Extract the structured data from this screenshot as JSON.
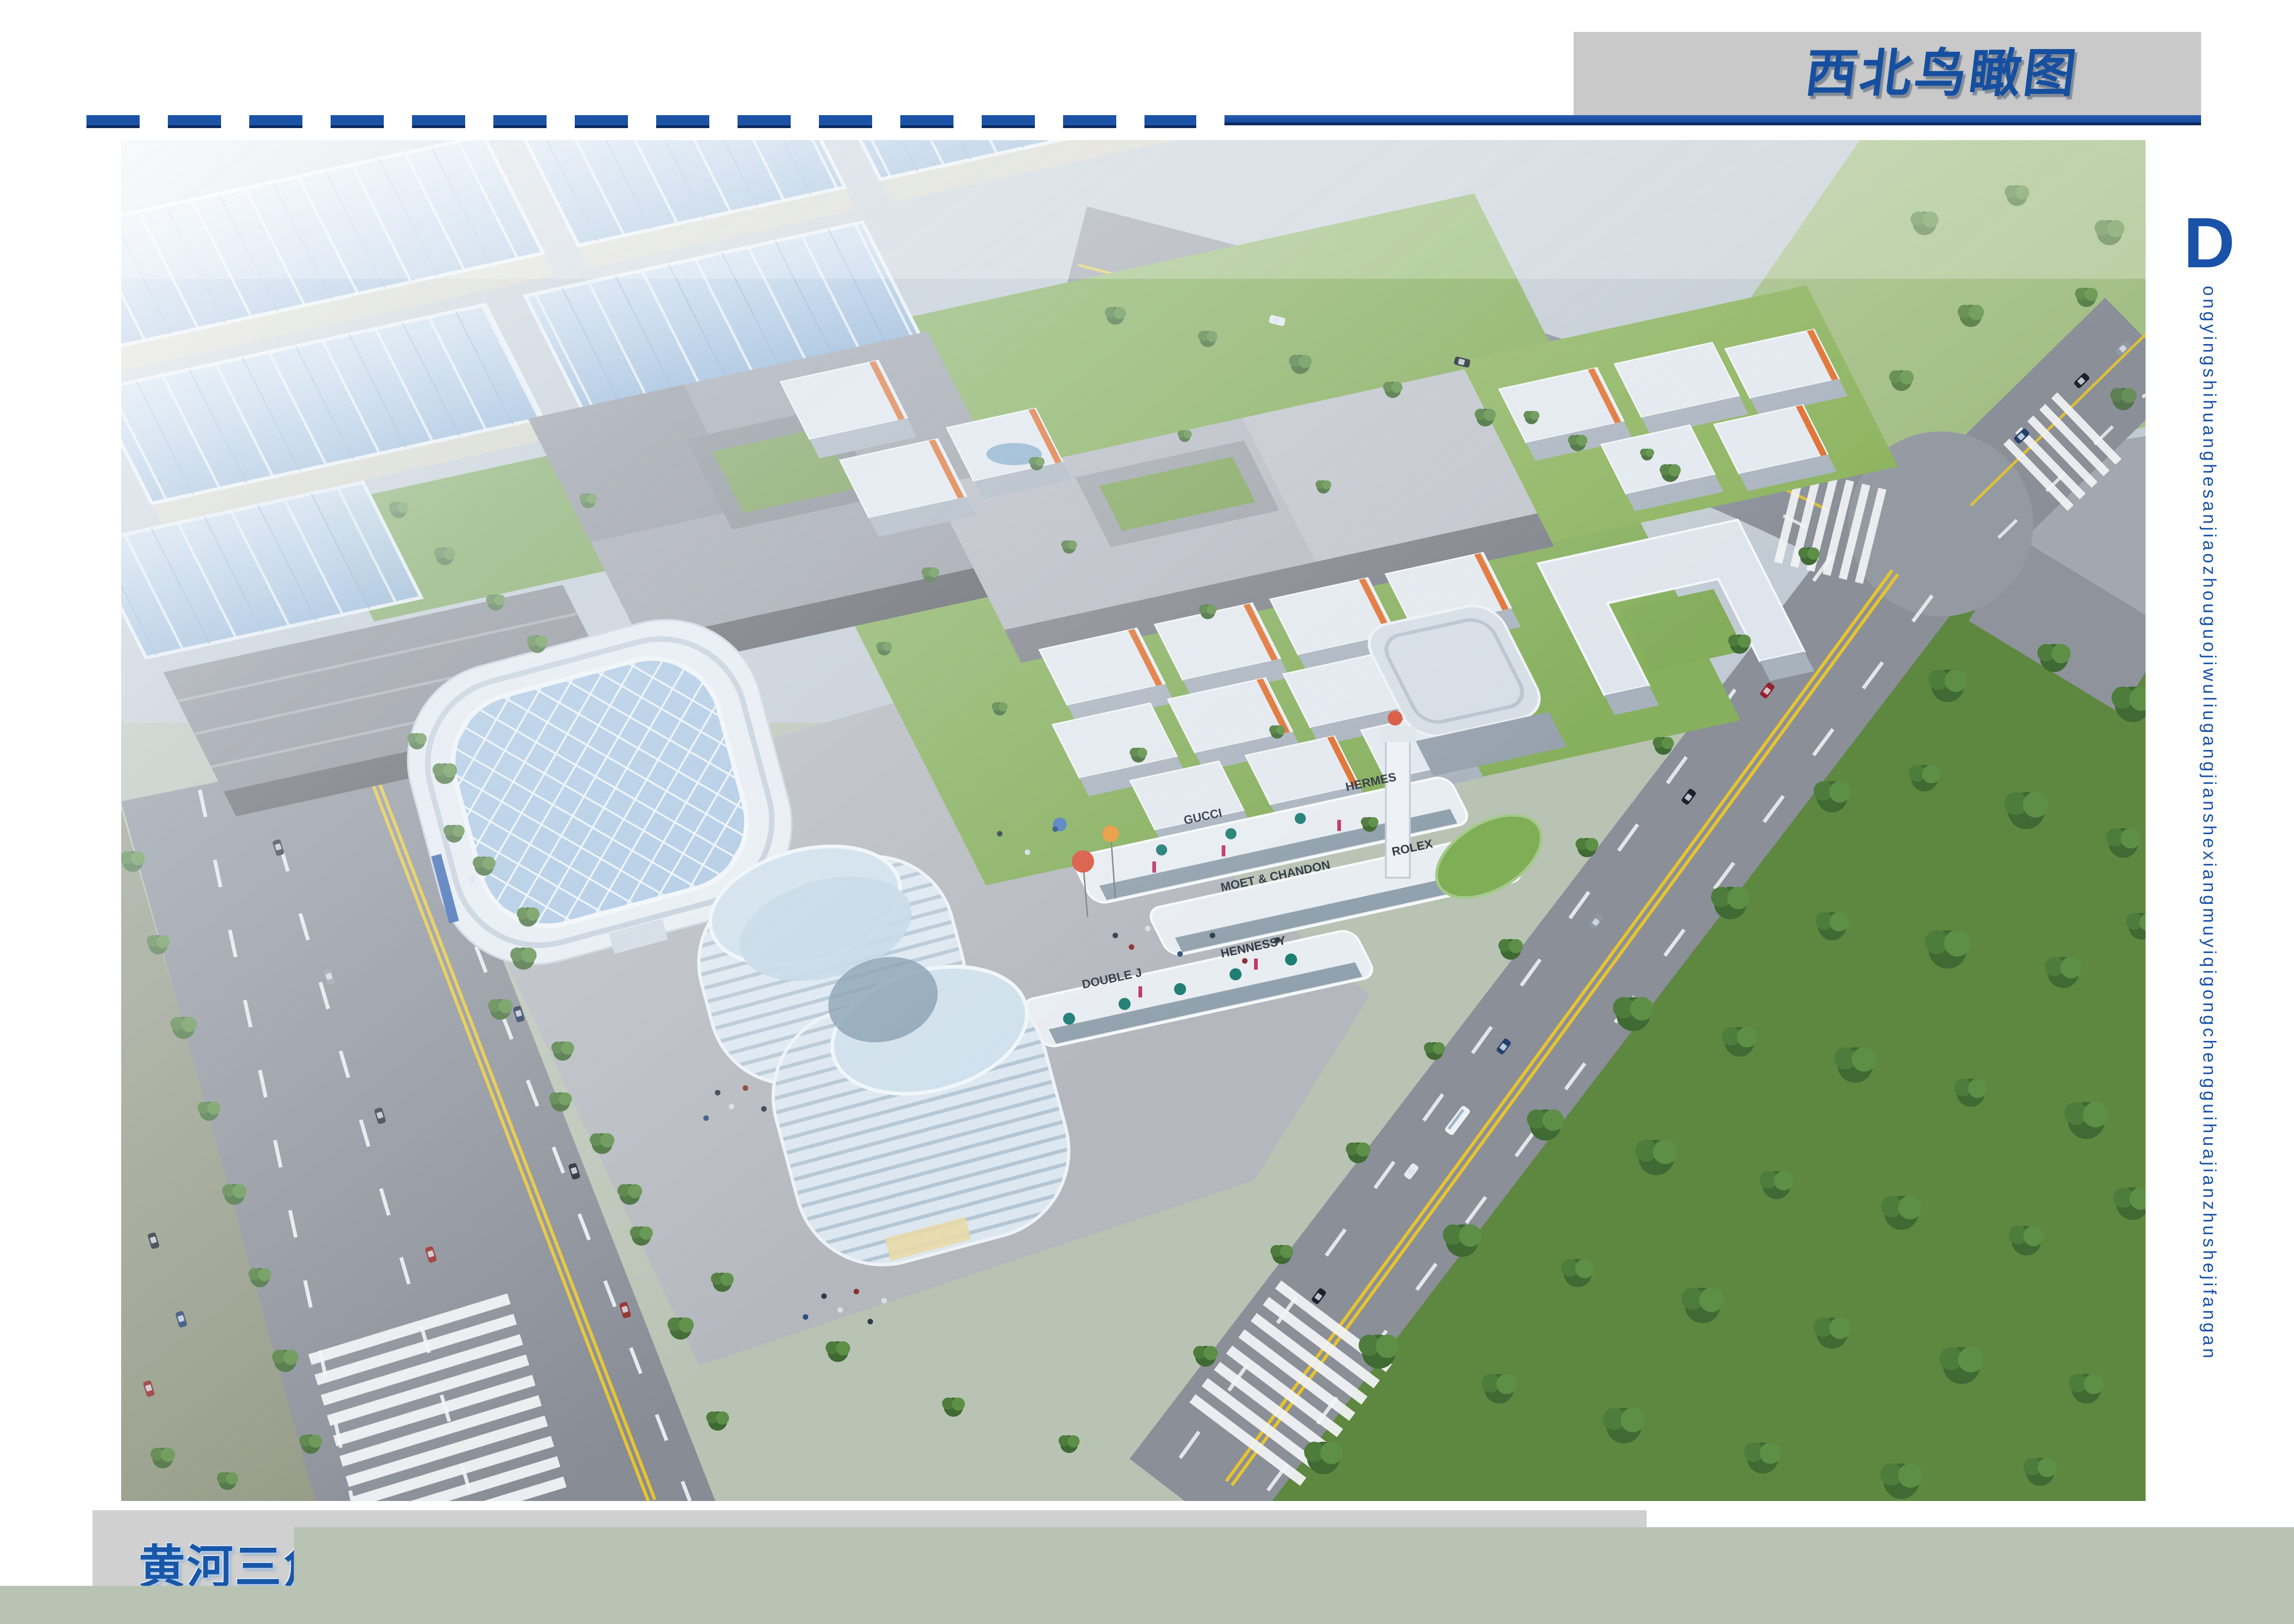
{
  "header": {
    "title": "西北鸟瞰图",
    "box_bg": "#c9c9c9",
    "rule_blue": "#1c53a6",
    "rule_dark": "#0b2a5e"
  },
  "footer": {
    "title": "黄河三角洲国际物流港一期工程生活配套服务区规划设计（方案一）",
    "bar_bg": "#d0d0d0",
    "title_color": "#1856a8"
  },
  "side": {
    "initial": "D",
    "text": "ongyingshihuanghesanjiaozhouguojiwuliugangjianshexiangmuyiqigongchengguihuajianzhushejifangan",
    "color": "#1a52a8"
  },
  "rendering": {
    "description": "Northwest aerial bird's-eye rendering: blue-roofed logistics warehouses upper left, large gray storage halls in the middle, a campus of white mid-rise buildings with orange accents, two curved landmark towers, a commercial street with balloons, tree-lined boulevard lower left, crossroads and dense forest on the right.",
    "storefront_signs": [
      "GUCCI",
      "MOET & CHANDON",
      "HERMES",
      "ROLEX",
      "DOUBLE J",
      "HENNESSY"
    ],
    "palette": {
      "accent_blue": "#1a52a8",
      "warehouse_roof_blue": "#9cbede",
      "building_white": "#e6ecf2",
      "accent_orange": "#e0702f",
      "lawn_green": "#88b15e",
      "forest_green": "#4e7a3a",
      "road_gray": "#868b94",
      "lane_yellow": "#e7c42e"
    }
  }
}
